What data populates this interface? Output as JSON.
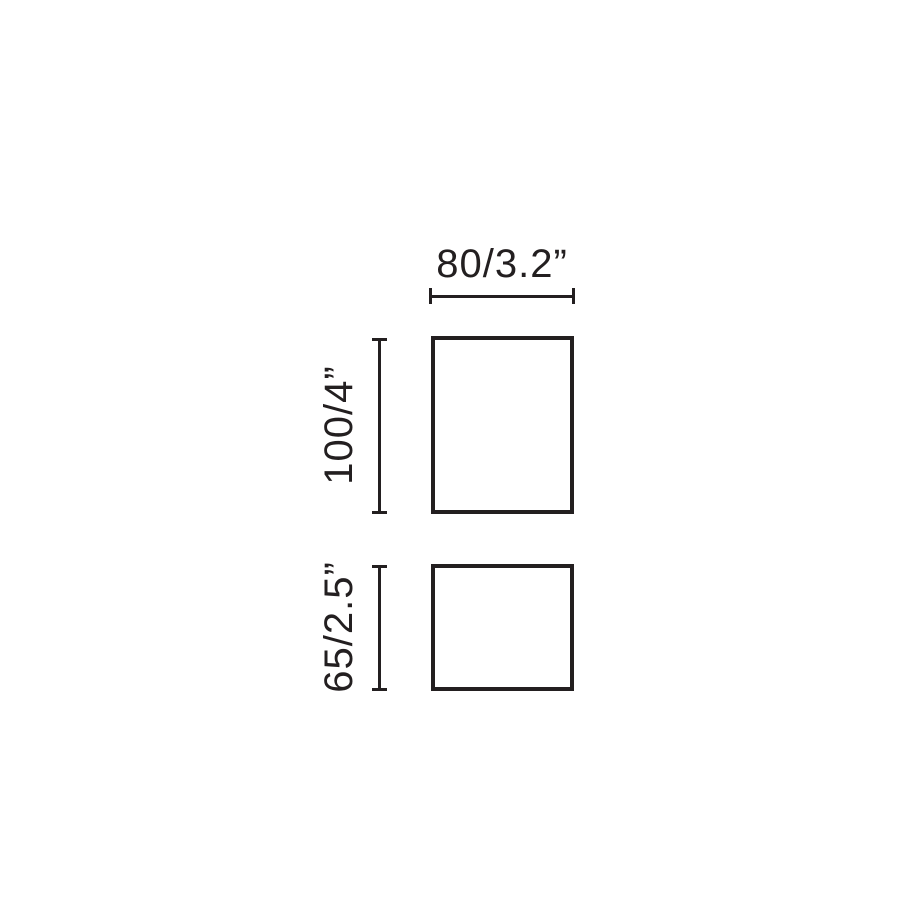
{
  "diagram": {
    "background": "#ffffff",
    "ink_color": "#231f20",
    "top_view": {
      "width_label": "80/3.2”",
      "height_label": "100/4”"
    },
    "bottom_view": {
      "height_label": "65/2.5”"
    }
  }
}
